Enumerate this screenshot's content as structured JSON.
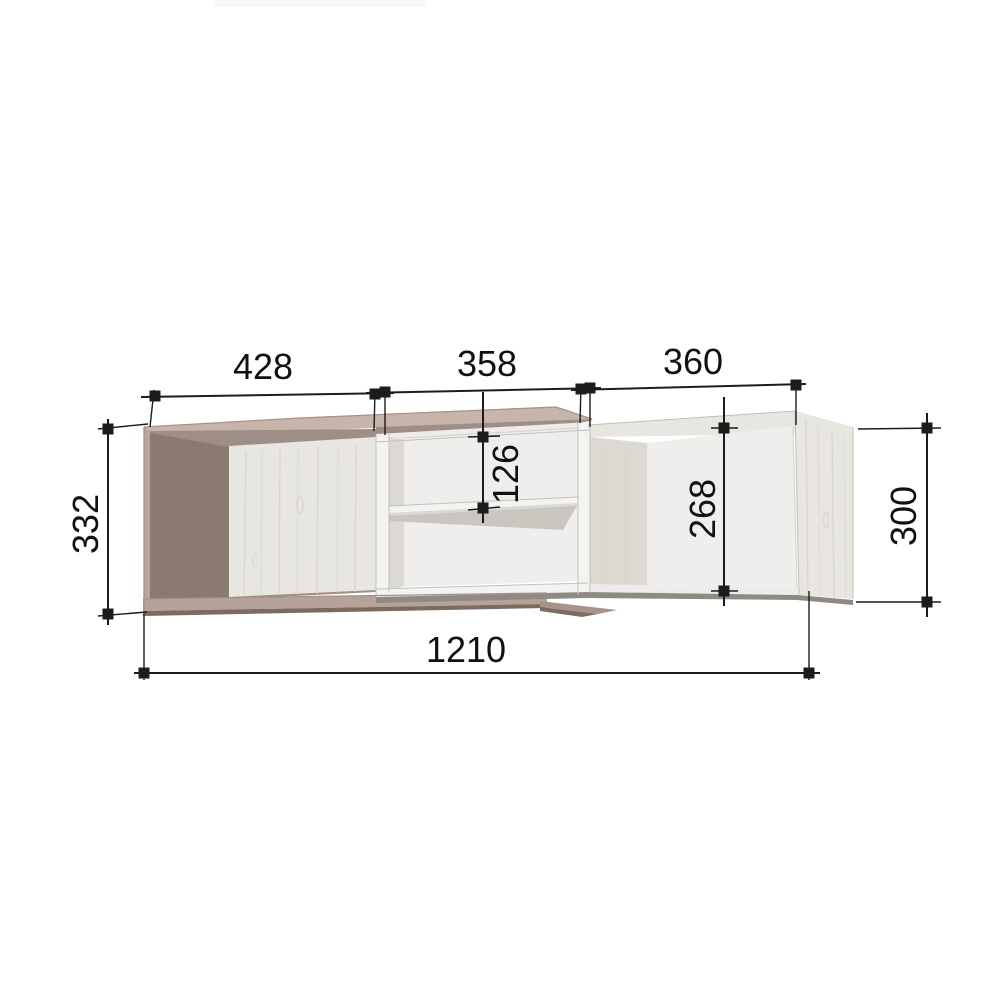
{
  "dimensions": {
    "top_left_width": "428",
    "top_middle_width": "358",
    "top_right_width": "360",
    "left_height": "332",
    "middle_shelf_offset": "126",
    "right_inner_height": "268",
    "right_outer_height": "300",
    "overall_width": "1210"
  },
  "colors": {
    "background": "#ffffff",
    "dimension_line": "#1c1c1c",
    "label_text": "#111111",
    "taupe_top": "#c7b5ac",
    "taupe_edge": "#b9a69c",
    "taupe_edge_line": "#a59388",
    "taupe_interior": "#9f8e86",
    "taupe_interior_dark": "#8b7a72",
    "taupe_bottom": "#b5a29a",
    "taupe_step": "#a8938a",
    "shadow_brown": "#7e6b5f",
    "wood_panel": "#e8e6e1",
    "wood_grain": "#d5d1c8",
    "white_panel": "#f3f3f1",
    "white_band": "#edecea",
    "interior_white": "#efeeec",
    "interior_shadow": "#dcd8d2",
    "shelf_underside": "#c9c5bf",
    "edge_gray": "#c2c0bb",
    "bottom_shadow_gray": "#8f8a84",
    "artifact_strip": "#f7f7f7"
  }
}
